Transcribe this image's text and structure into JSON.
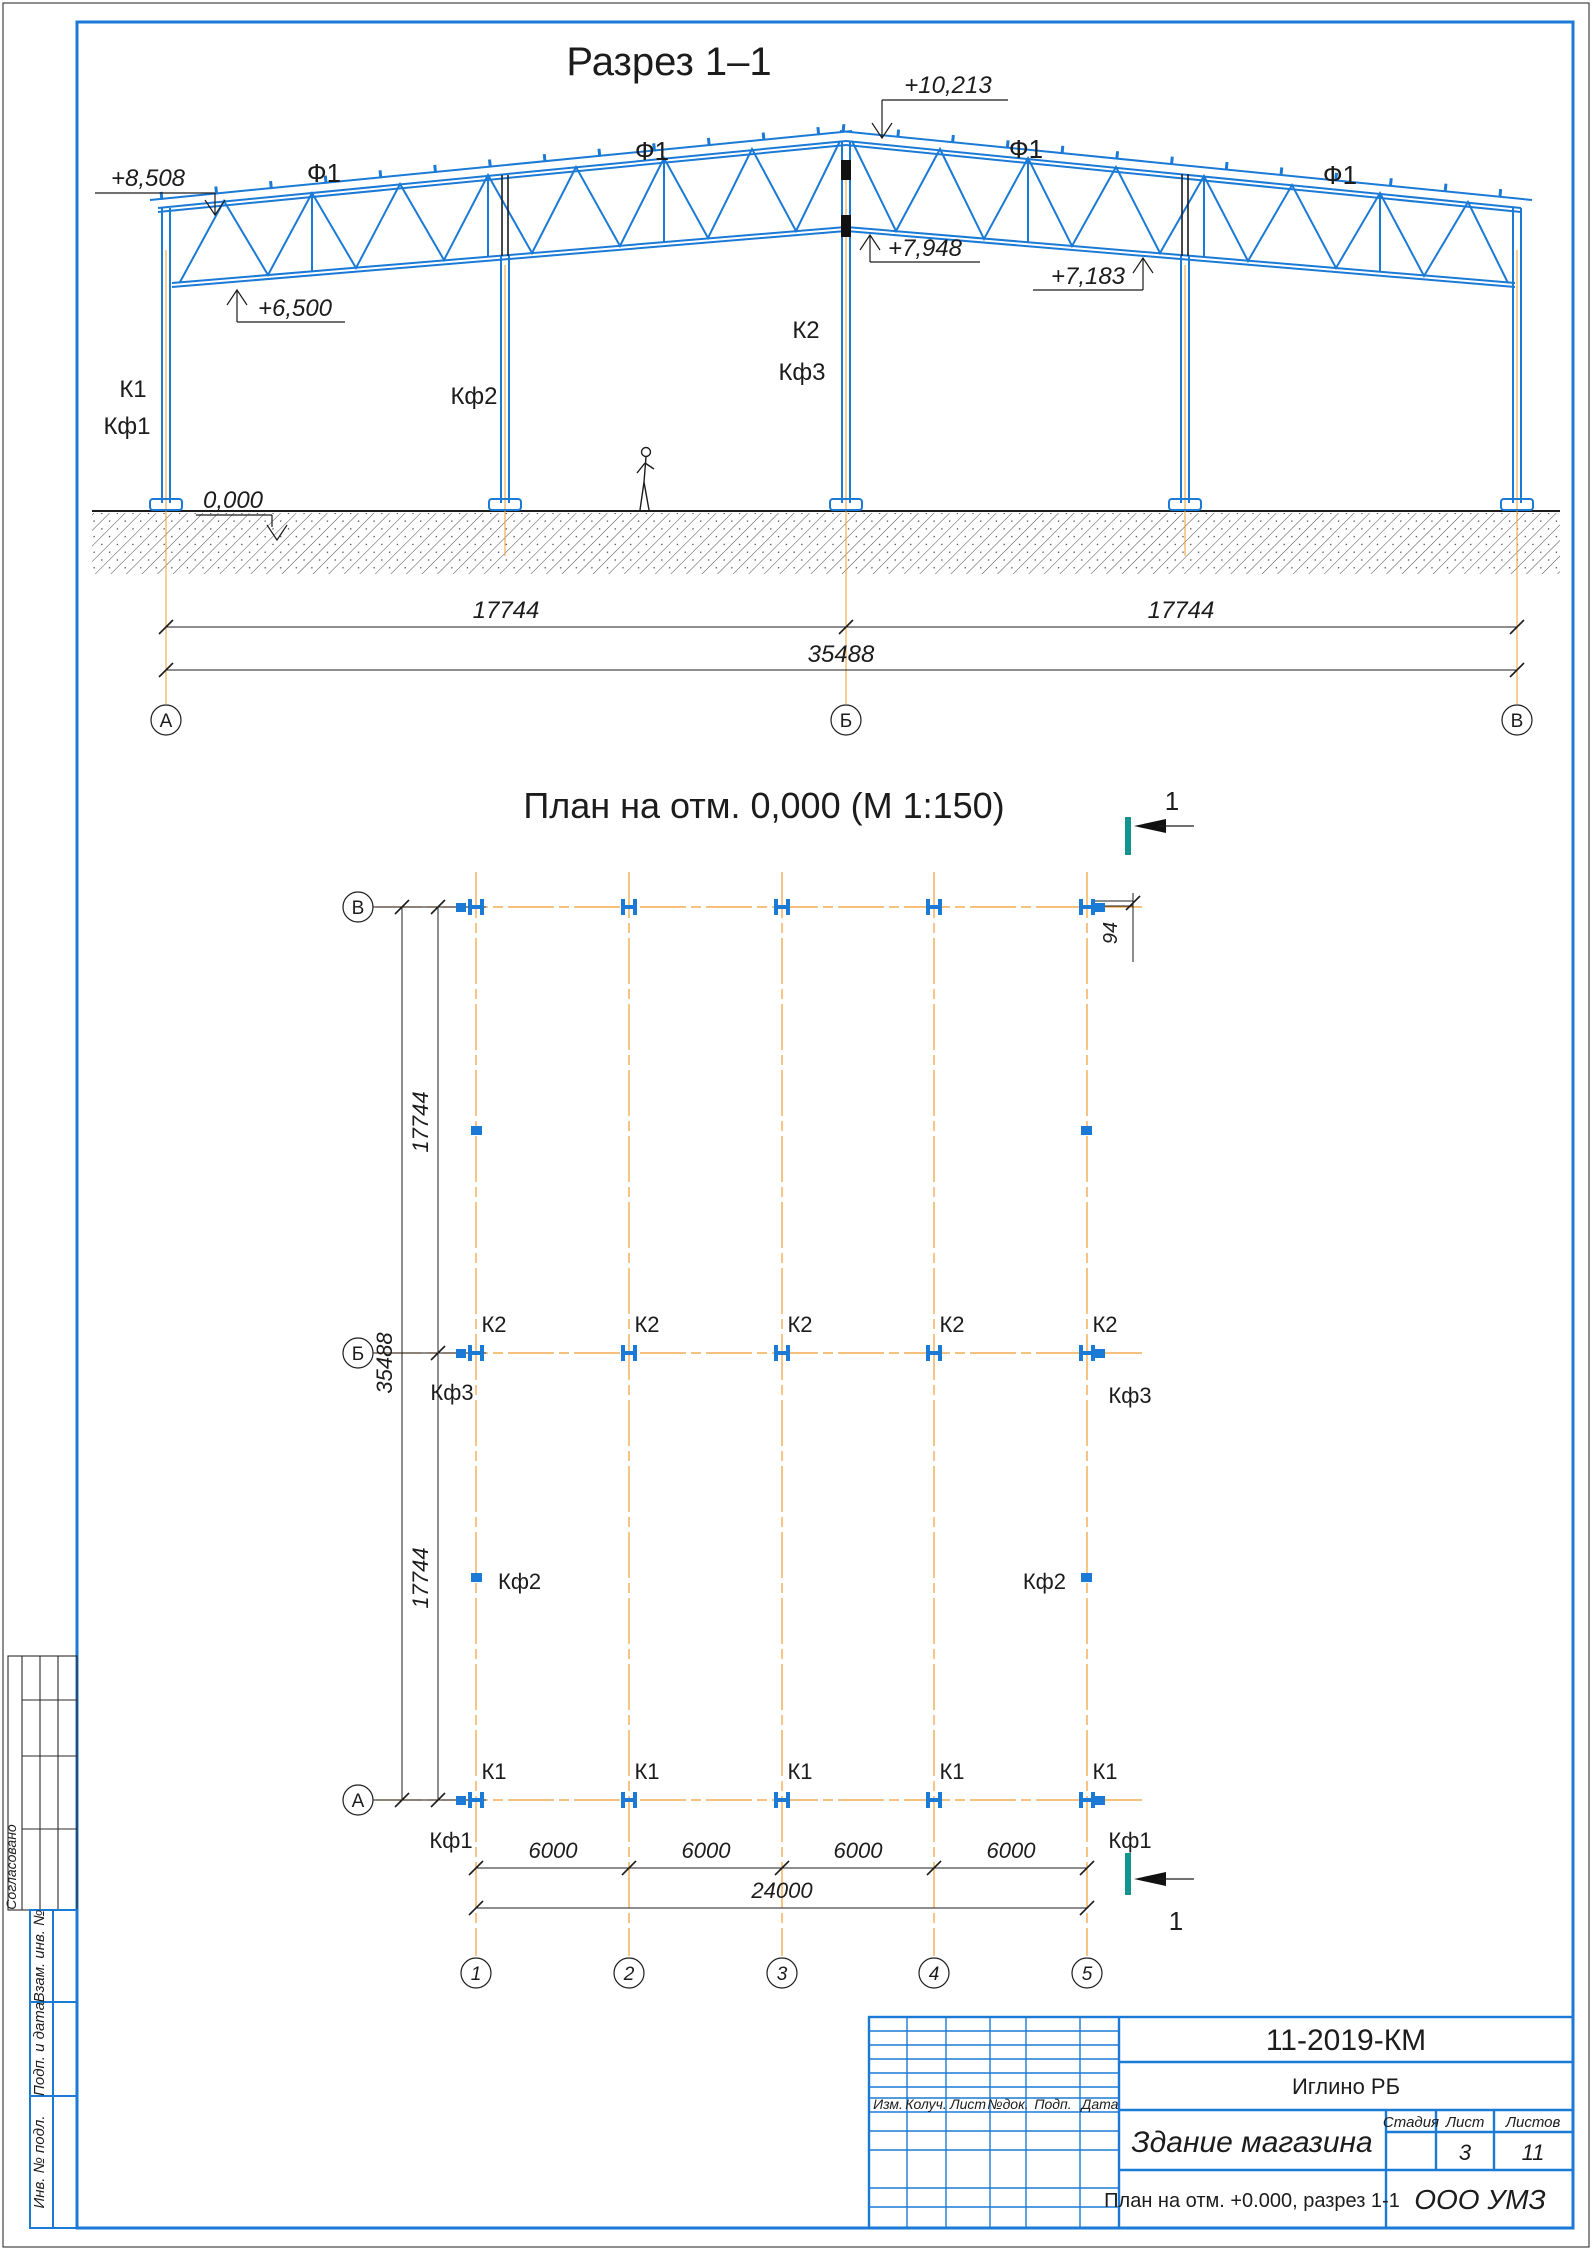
{
  "accent_colors": {
    "structure_blue": "#1b7ad6",
    "axis_orange": "#f09c32",
    "cut_teal": "#11948e",
    "line_black": "#1c1c1c"
  },
  "section": {
    "title": "Разрез 1–1",
    "truss_labels": [
      "Ф1",
      "Ф1",
      "Ф1",
      "Ф1"
    ],
    "elev_eave_left": "+8,508",
    "elev_ridge": "+10,213",
    "elev_bottom_mid": "+7,948",
    "elev_bottom_right": "+7,183",
    "elev_bottom_left": "+6,500",
    "elev_ground": "0,000",
    "col_k1": "К1",
    "col_kf1": "Кф1",
    "col_kf2": "Кф2",
    "col_k2": "К2",
    "col_kf3": "Кф3",
    "dim_left": "17744",
    "dim_right": "17744",
    "dim_total": "35488",
    "axis_a": "А",
    "axis_b": "Б",
    "axis_v": "В"
  },
  "plan": {
    "title": "План на отм. 0,000 (М 1:150)",
    "cut_label_top": "1",
    "cut_label_bottom": "1",
    "row_v": "В",
    "row_b": "Б",
    "row_a": "А",
    "axes": [
      "1",
      "2",
      "3",
      "4",
      "5"
    ],
    "k2_labels": [
      "К2",
      "К2",
      "К2",
      "К2",
      "К2"
    ],
    "k1_labels": [
      "К1",
      "К1",
      "К1",
      "К1",
      "К1"
    ],
    "kf3_left": "Кф3",
    "kf3_right": "Кф3",
    "kf1_left": "Кф1",
    "kf1_right": "Кф1",
    "kf2_left": "Кф2",
    "kf2_right": "Кф2",
    "dim_span_top": "17744",
    "dim_span_bottom": "17744",
    "dim_total": "35488",
    "dim_offset": "94",
    "bay_dims": [
      "6000",
      "6000",
      "6000",
      "6000"
    ],
    "dim_bay_total": "24000"
  },
  "titleblock": {
    "doc_number": "11-2019-КМ",
    "location": "Иглино РБ",
    "header_cols": [
      "Изм.",
      "Колуч.",
      "Лист",
      "№док.",
      "Подп.",
      "Дата"
    ],
    "project": "Здание магазина",
    "stage_label": "Стадия",
    "sheet_label": "Лист",
    "sheets_label": "Листов",
    "sheet_value": "3",
    "sheets_value": "11",
    "sheet_title": "План на отм. +0.000, разрез 1-1",
    "company": "ООО УМЗ"
  },
  "sidebar": {
    "approved": "Согласовано",
    "row1": "Взам. инв. №",
    "row2": "Подп. и дата",
    "row3": "Инв. № подл."
  }
}
